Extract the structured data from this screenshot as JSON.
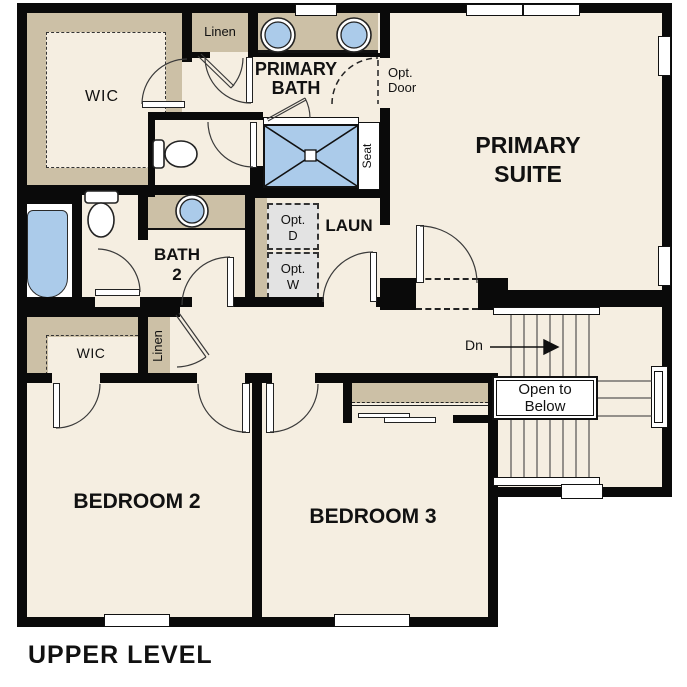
{
  "plan": {
    "title": "UPPER LEVEL",
    "rooms": {
      "primary_suite": "PRIMARY SUITE",
      "primary_bath": "PRIMARY BATH",
      "wic_primary": "WIC",
      "bath2": "BATH 2",
      "laundry": "LAUN",
      "bedroom2": "BEDROOM 2",
      "bedroom3": "BEDROOM 3",
      "wic_bedroom2": "WIC"
    },
    "closets": {
      "linen_upper": "Linen",
      "linen_hall": "Linen"
    },
    "annotations": {
      "opt_door": "Opt. Door",
      "opt_dryer": "Opt. D",
      "opt_washer": "Opt. W",
      "seat": "Seat",
      "stairs_down": "Dn",
      "open_to_below": "Open to Below"
    },
    "colors": {
      "floor": "#f5eee1",
      "wall": "#0a0a0a",
      "counter_tan": "#ccc0a6",
      "fixture_blue": "#abcbea",
      "optional_gray": "#e3e3e3",
      "outside": "#ffffff"
    }
  }
}
